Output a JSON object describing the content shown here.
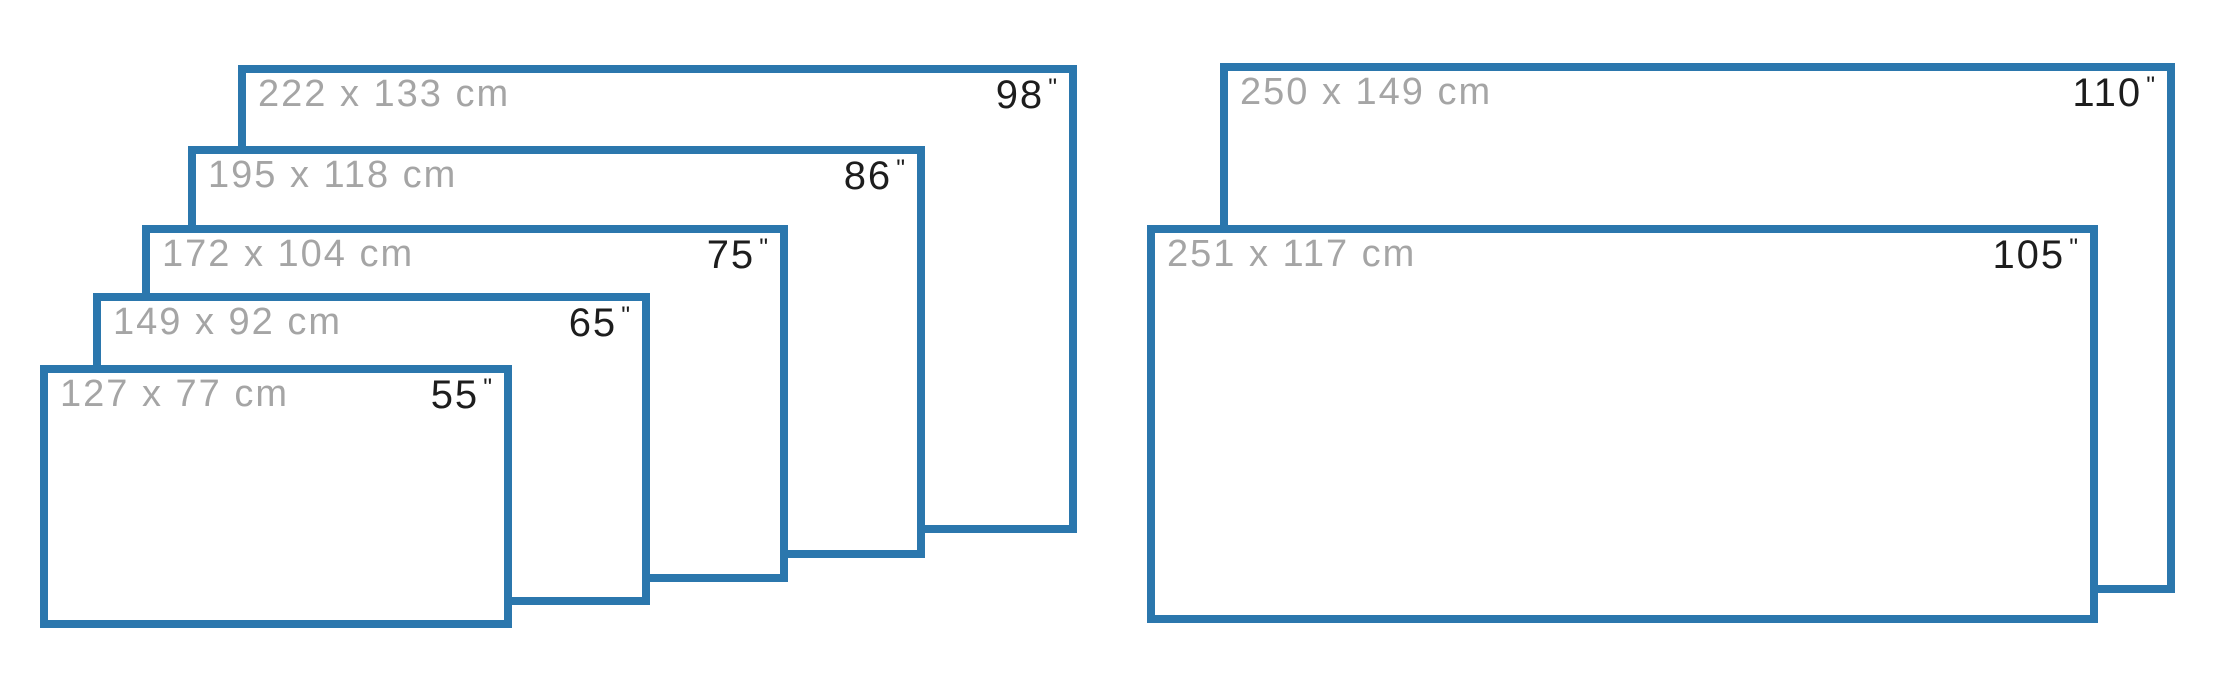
{
  "diagram": {
    "inch_mark": "\"",
    "colors": {
      "border": "#2b77ad",
      "cm_text": "#a5a5a5",
      "inch_text": "#1d1d1d",
      "background": "#ffffff"
    },
    "groups": [
      {
        "screens": [
          {
            "cm_label": "222 x 133 cm",
            "inches": "98",
            "box": {
              "x": 238,
              "y": 65,
              "w": 839,
              "h": 468
            }
          },
          {
            "cm_label": "195 x 118 cm",
            "inches": "86",
            "box": {
              "x": 188,
              "y": 146,
              "w": 737,
              "h": 412
            }
          },
          {
            "cm_label": "172 x 104 cm",
            "inches": "75",
            "box": {
              "x": 142,
              "y": 225,
              "w": 646,
              "h": 357
            }
          },
          {
            "cm_label": "149 x 92 cm",
            "inches": "65",
            "box": {
              "x": 93,
              "y": 293,
              "w": 557,
              "h": 312
            }
          },
          {
            "cm_label": "127 x 77 cm",
            "inches": "55",
            "box": {
              "x": 40,
              "y": 365,
              "w": 472,
              "h": 263
            }
          }
        ]
      },
      {
        "screens": [
          {
            "cm_label": "250 x 149 cm",
            "inches": "110",
            "box": {
              "x": 1220,
              "y": 63,
              "w": 955,
              "h": 530
            }
          },
          {
            "cm_label": "251 x 117 cm",
            "inches": "105",
            "box": {
              "x": 1147,
              "y": 225,
              "w": 951,
              "h": 398
            }
          }
        ]
      }
    ]
  }
}
